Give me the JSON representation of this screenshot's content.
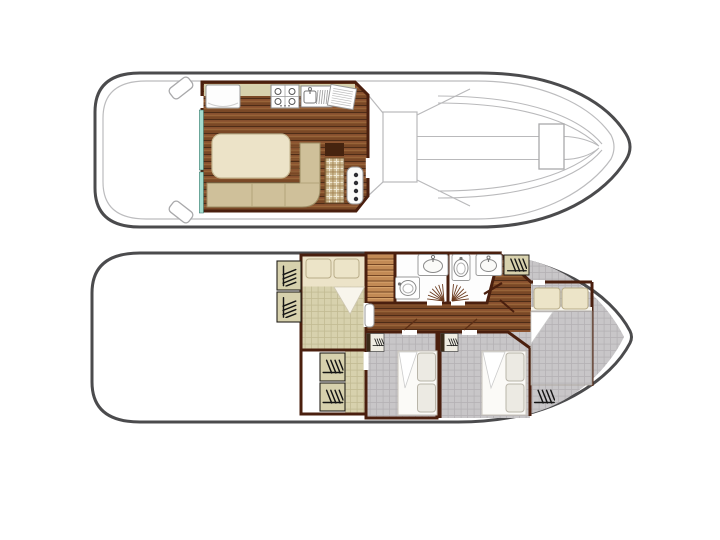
{
  "document": {
    "type": "boat-floor-plan",
    "view": "top-down deck plans",
    "decks_shown": 2,
    "visible_text": ""
  },
  "colors": {
    "hull_outline": "#4b4b4d",
    "deck_line": "#bcbcbe",
    "interior_wall": "#4a1f0e",
    "wood_floor": "#7a4826",
    "stairs_wood": "#c28a55",
    "khaki_furniture": "#d7d1ad",
    "khaki_grid_line": "#c2bb92",
    "gray_carpet": "#c8c6c8",
    "gray_grid_line": "#b4b1b4",
    "cream_furniture": "#ece3c8",
    "sofa_tan": "#cfc09a",
    "window_teal": "#a5dccf",
    "background": "#ffffff"
  },
  "decks": [
    {
      "name": "upper-deck",
      "position": "top",
      "rooms": [
        {
          "name": "aft-deck",
          "features": [
            "boarding-step-port",
            "boarding-step-starboard"
          ]
        },
        {
          "name": "saloon-galley",
          "features": [
            "refrigerator",
            "stove-top-4-burner",
            "sink-with-drainer",
            "drain-rack",
            "dinette-table",
            "l-shaped-sofa",
            "side-cabinet",
            "plaid-bench",
            "helm-seat",
            "window-strip-aft",
            "window-strip-fwd",
            "side-door"
          ]
        },
        {
          "name": "foredeck",
          "features": [
            "windshield",
            "walkway-contours",
            "deck-hatch"
          ]
        }
      ]
    },
    {
      "name": "lower-deck",
      "position": "bottom",
      "rooms": [
        {
          "name": "aft-cabin",
          "features": [
            "double-bed",
            "pillow",
            "pillow",
            "wardrobe",
            "wardrobe",
            "door"
          ]
        },
        {
          "name": "aft-dressing-area",
          "features": [
            "wardrobe",
            "wardrobe"
          ]
        },
        {
          "name": "companionway-stairs",
          "features": [
            "steps"
          ]
        },
        {
          "name": "bathroom-port",
          "features": [
            "washbasin",
            "toilet",
            "folding-door-swing"
          ]
        },
        {
          "name": "bathroom-starboard",
          "features": [
            "washbasin",
            "toilet",
            "folding-door-swing",
            "open-door-leaf"
          ]
        },
        {
          "name": "corridor",
          "features": [
            "wood-floor"
          ]
        },
        {
          "name": "mid-cabin-port",
          "features": [
            "bed",
            "pillow",
            "pillow",
            "hanging-locker",
            "door"
          ]
        },
        {
          "name": "mid-cabin-starboard",
          "features": [
            "bed",
            "pillow",
            "pillow",
            "hanging-locker",
            "door"
          ]
        },
        {
          "name": "bow-cabin",
          "features": [
            "double-bed",
            "pillow",
            "pillow",
            "wardrobe",
            "wardrobe",
            "door"
          ]
        }
      ]
    }
  ]
}
